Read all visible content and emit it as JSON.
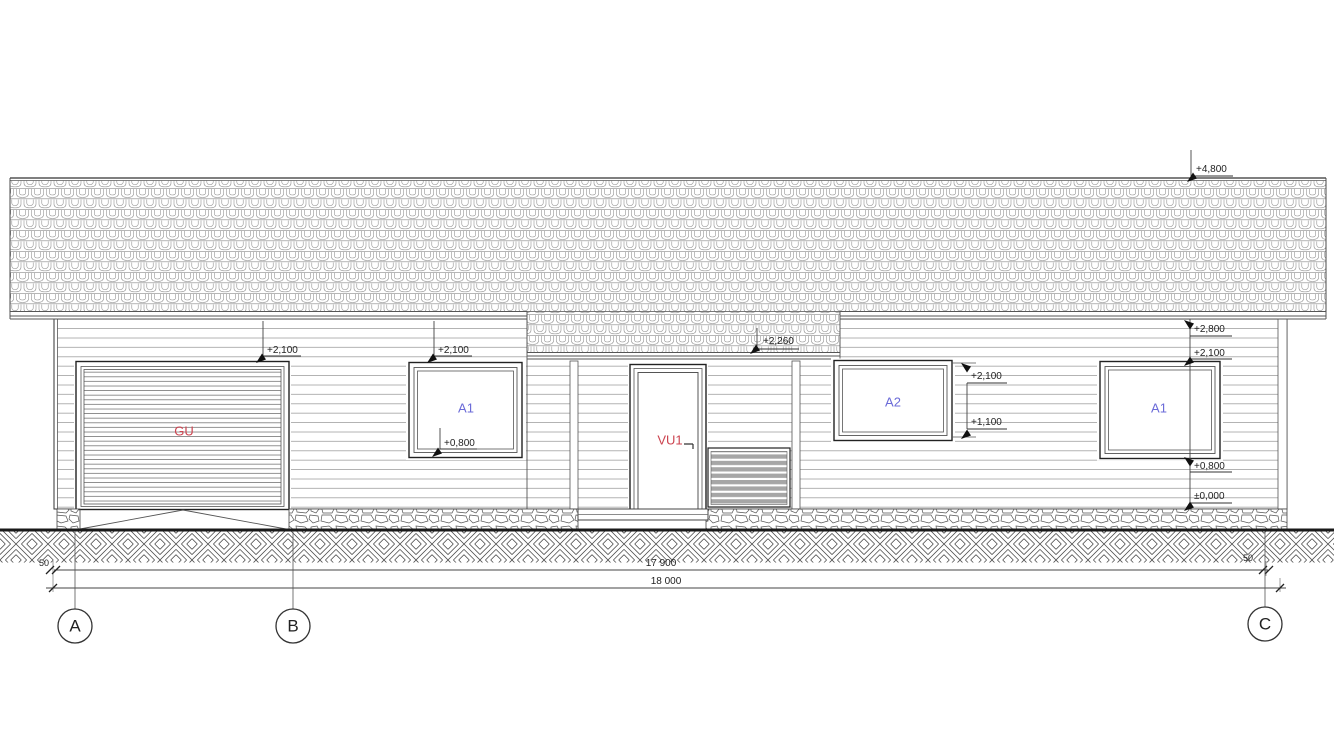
{
  "drawing_type": "house-front-elevation",
  "labels": {
    "lvl_ridge": "+4,800",
    "lvl_eave": "+2,800",
    "lvl_porch_eave": "+2,260",
    "lvl_garage_head": "+2,100",
    "lvl_win_left_head": "+2,100",
    "lvl_win_left_sill": "+0,800",
    "lvl_a2_head": "+2,100",
    "lvl_a2_sill": "+1,100",
    "lvl_win_right_head": "+2,100",
    "lvl_win_right_sill": "+0,800",
    "lvl_zero": "±0,000",
    "dim_grid_span": "17 900",
    "dim_overall": "18 000",
    "offset_left": "50",
    "offset_right": "50",
    "garage_door": "GU",
    "entrance_door": "VU1",
    "window_left": "A1",
    "window_mid": "A2",
    "window_right": "A1",
    "grid_a": "A",
    "grid_b": "B",
    "grid_c": "C"
  },
  "colors": {
    "window_label": "#6b6bd8",
    "door_label": "#cc4450",
    "line": "#333333"
  }
}
